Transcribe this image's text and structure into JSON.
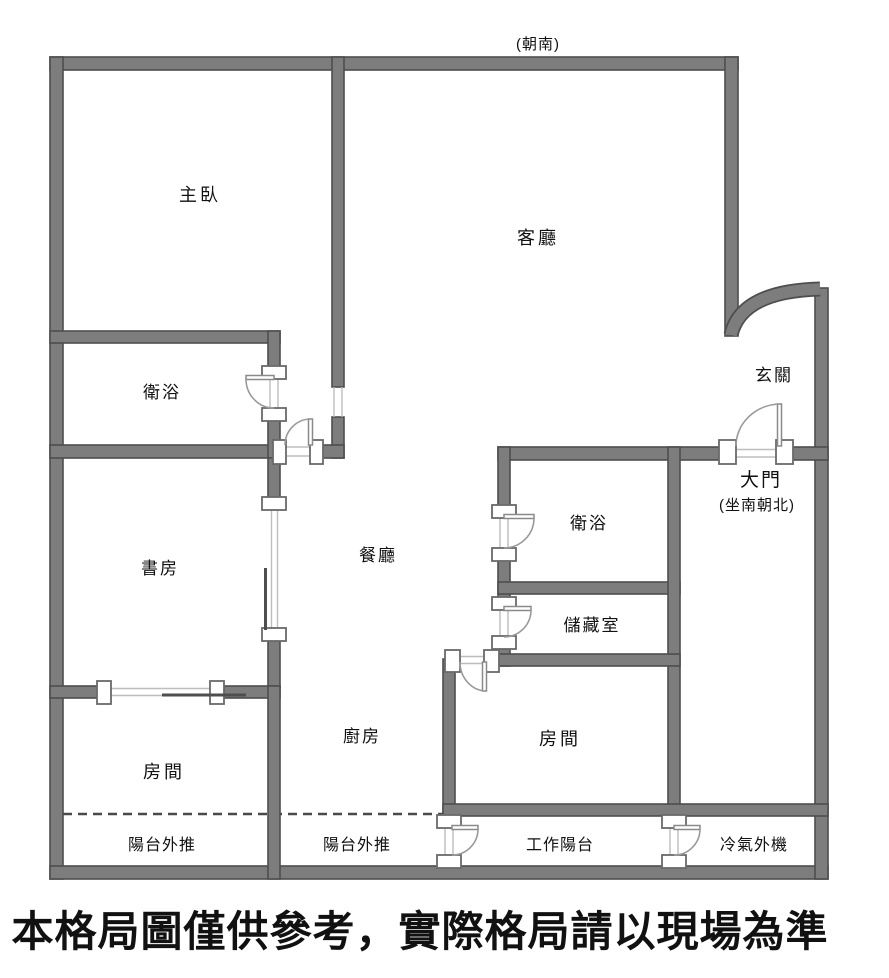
{
  "plan": {
    "orientation_note": "(朝南)",
    "labels": {
      "master_bedroom": "主臥",
      "living_room": "客廳",
      "master_bath": "衛浴",
      "foyer": "玄關",
      "main_door": "大門",
      "main_door_note": "(坐南朝北)",
      "study": "書房",
      "dining_room": "餐廳",
      "bathroom2": "衛浴",
      "storage_room": "儲藏室",
      "bedroom_right": "房間",
      "kitchen": "廚房",
      "bedroom_left": "房間",
      "balcony_pushout_left": "陽台外推",
      "balcony_pushout_middle": "陽台外推",
      "work_balcony": "工作陽台",
      "ac_outdoor_unit": "冷氣外機"
    },
    "disclaimer": "本格局圖僅供參考，實際格局請以現場為準",
    "colors": {
      "wall_fill": "#7d7d7d",
      "wall_edge": "#4e4e4e",
      "opening_line": "#bdbdbd",
      "door_arc": "#9a9a9a",
      "text": "#111111",
      "background": "#ffffff"
    }
  }
}
